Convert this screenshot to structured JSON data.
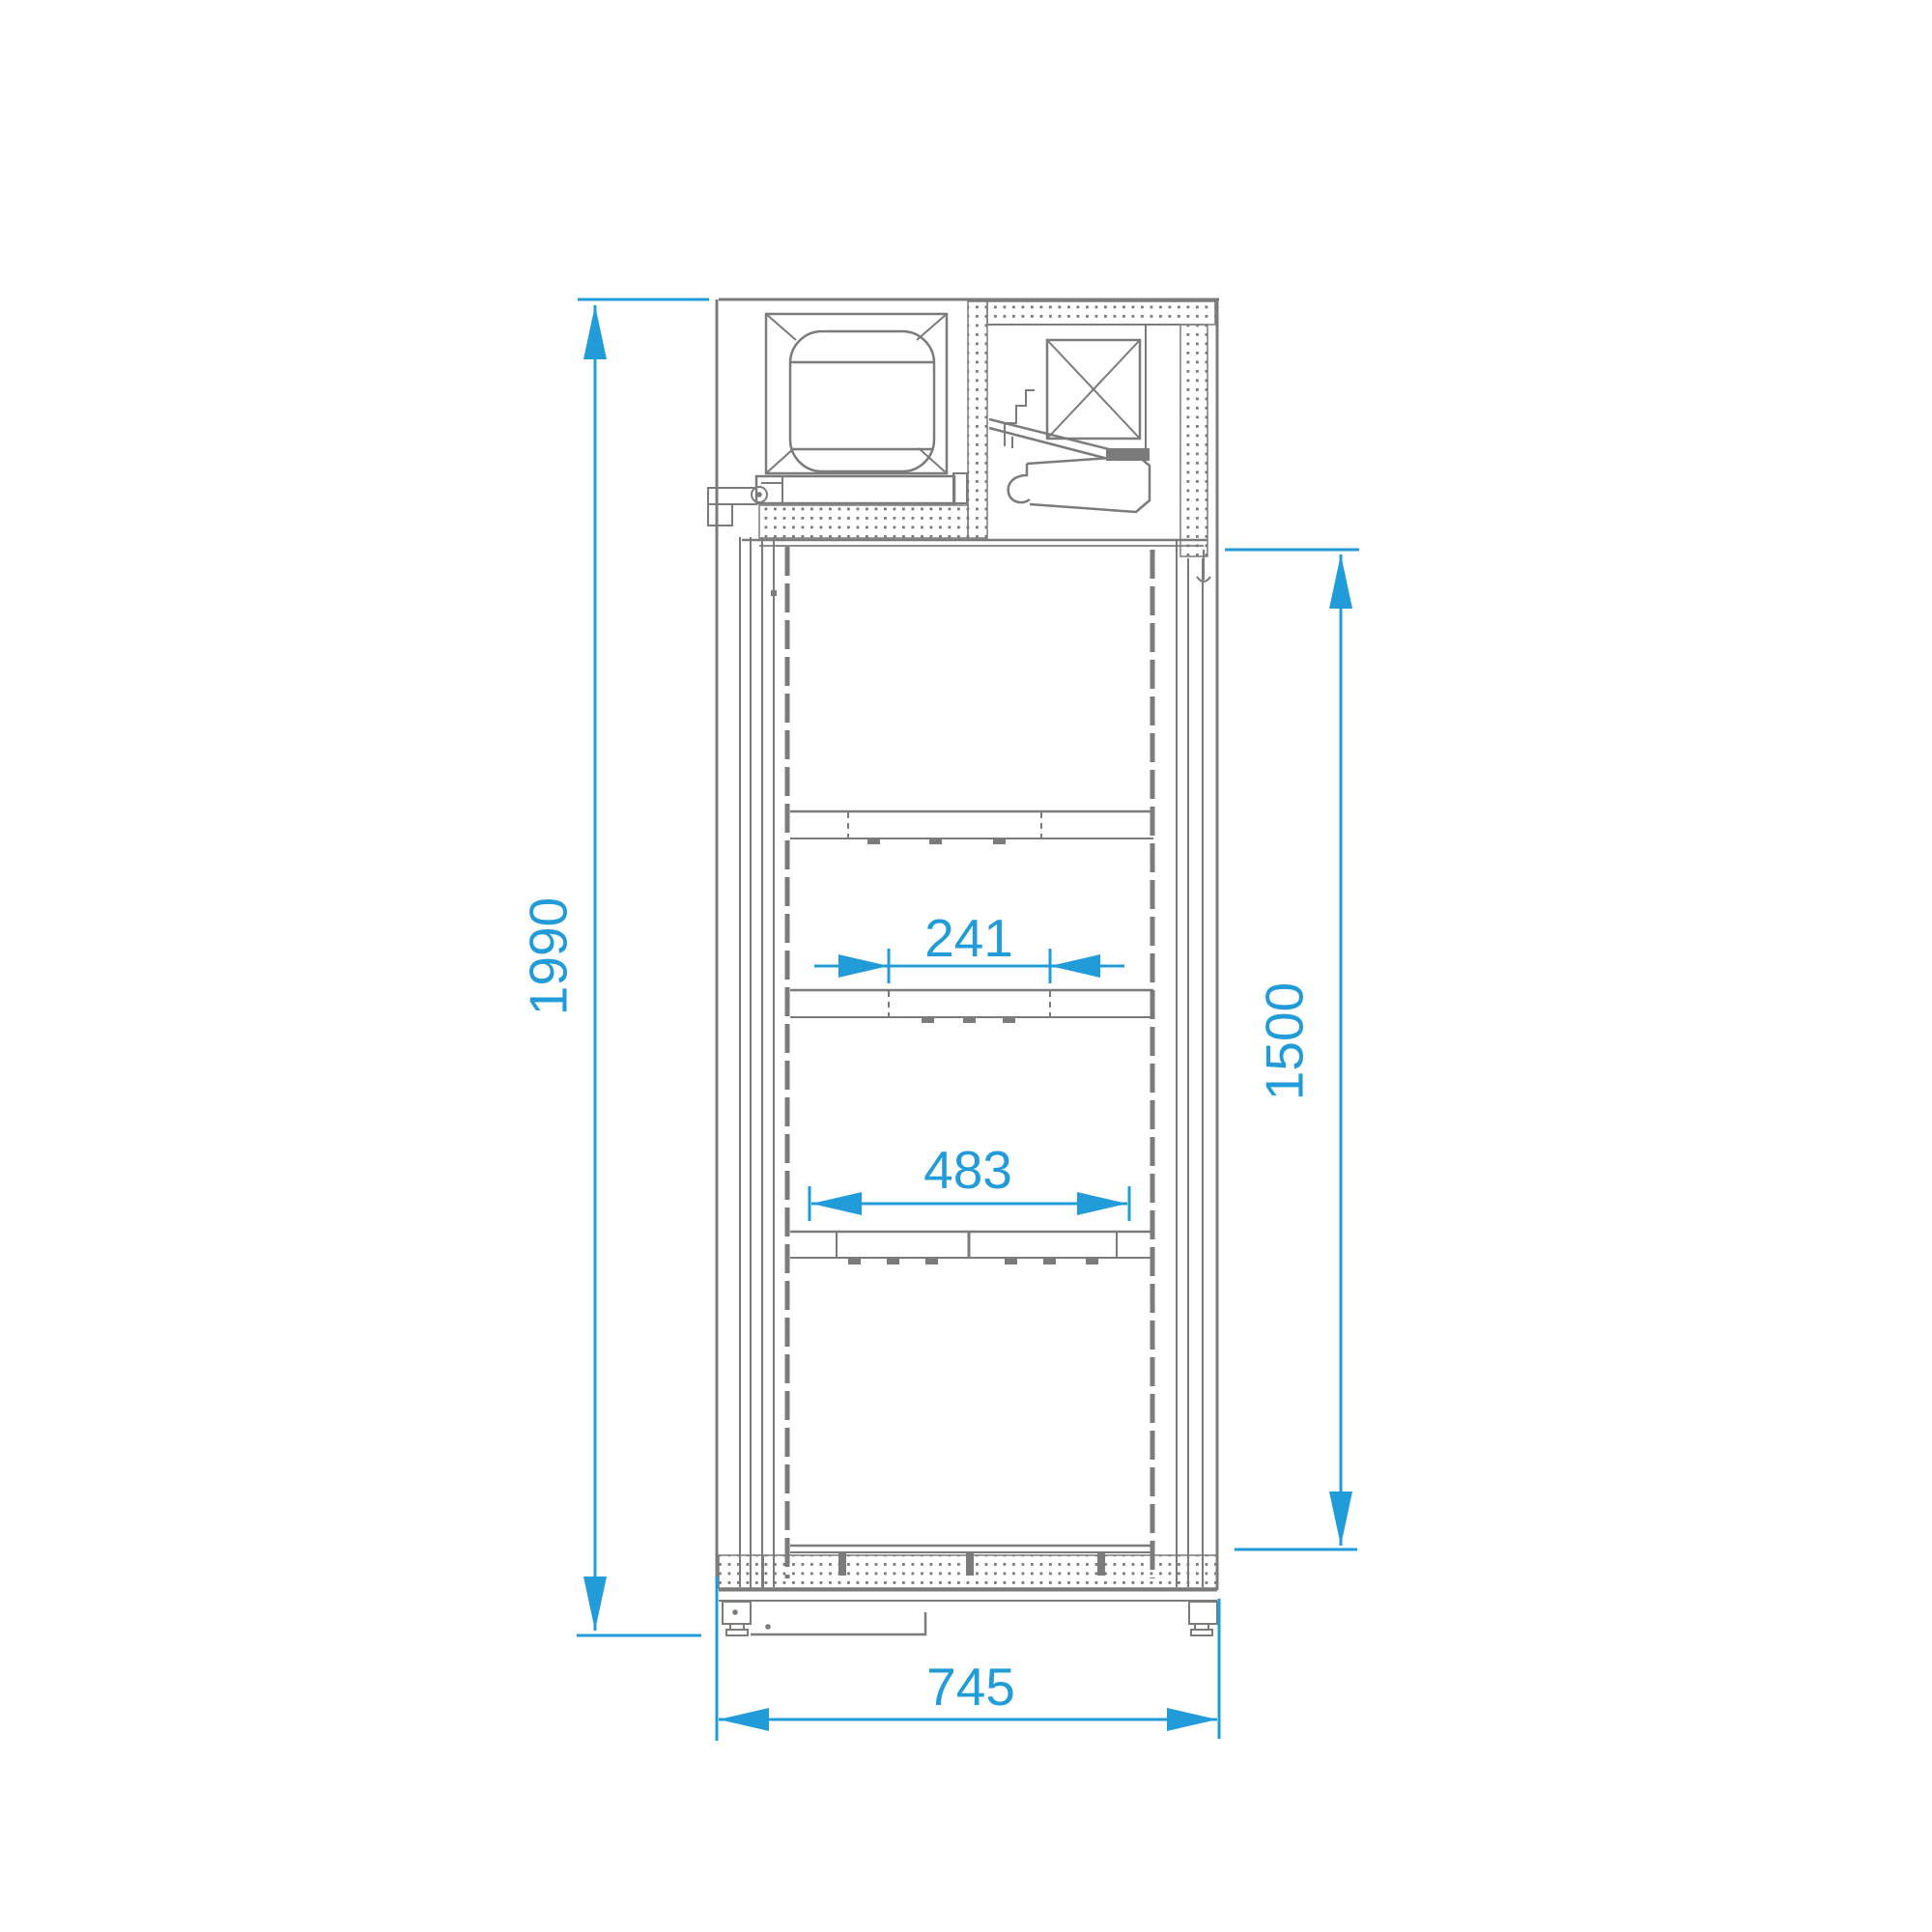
{
  "drawing": {
    "kind": "cabinet-section-technical-drawing",
    "dimensions": {
      "overall_height_mm": "1990",
      "interior_height_mm": "1500",
      "upper_shelf_clear_mm": "241",
      "lower_shelf_width_mm": "483",
      "overall_depth_mm": "745"
    },
    "colors": {
      "dimension_accent": "#219cd8",
      "drawing_line": "#7b7b7b",
      "background": "#ffffff"
    }
  }
}
